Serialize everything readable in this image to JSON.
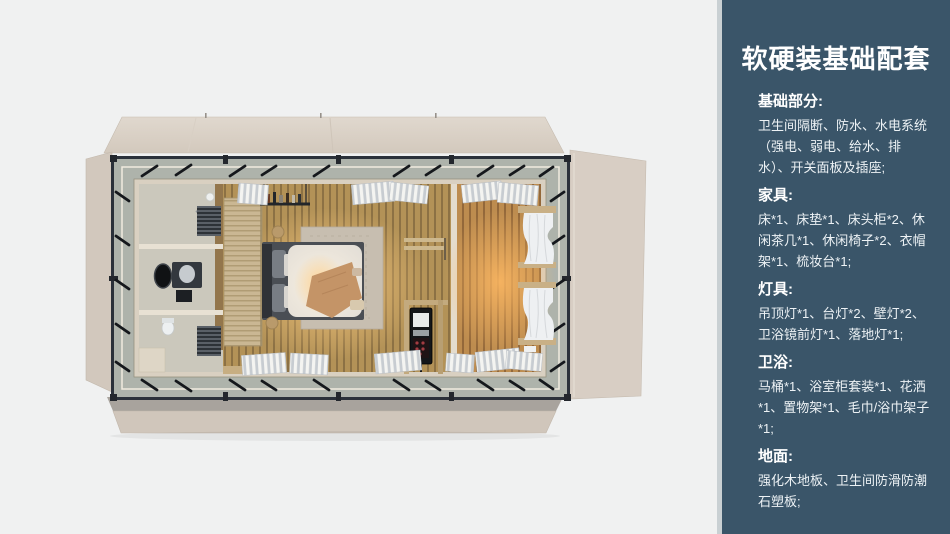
{
  "sidebar": {
    "title": "软硬装基础配套",
    "sections": [
      {
        "heading": "基础部分:",
        "body": "卫生间隔断、防水、水电系统（强电、弱电、给水、排水）、开关面板及插座;"
      },
      {
        "heading": "家具:",
        "body": "床*1、床垫*1、床头柜*2、休闲茶几*1、休闲椅子*2、衣帽架*1、梳妆台*1;"
      },
      {
        "heading": "灯具:",
        "body": "吊顶灯*1、台灯*2、壁灯*2、卫浴镜前灯*1、落地灯*1;"
      },
      {
        "heading": "卫浴:",
        "body": "马桶*1、浴室柜套装*1、花洒*1、置物架*1、毛巾/浴巾架子*1;"
      },
      {
        "heading": "地面:",
        "body": "强化木地板、卫生间防滑防潮石塑板;"
      }
    ]
  },
  "colors": {
    "sidebar_background": "#3a5569",
    "divider_strip": "#c9d0d3",
    "page_background": "#f0f1f1",
    "container_panel": "#d5cbc0",
    "steel_frame": "#2b313a",
    "wood_floor": "#b39257",
    "warm_light": "#ffcd82"
  }
}
